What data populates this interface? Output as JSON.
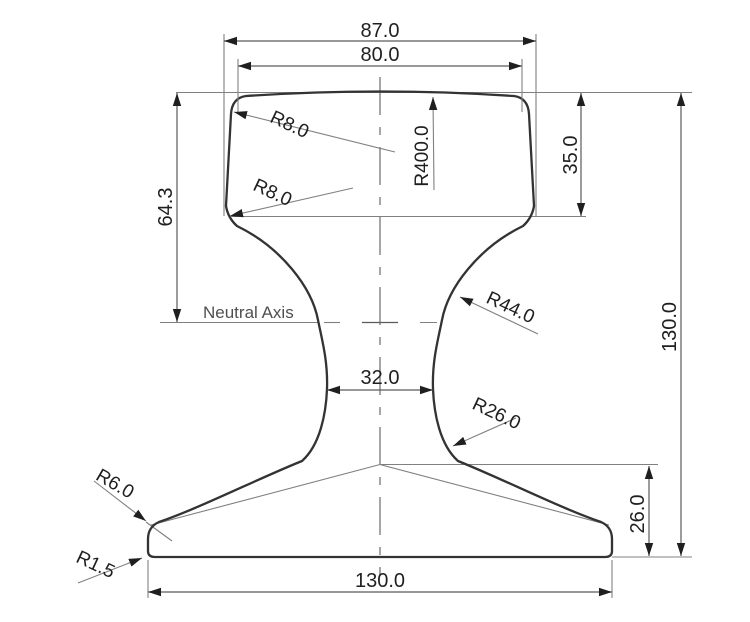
{
  "drawing": {
    "title": "Rail cross-section engineering drawing",
    "labels": {
      "neutral_axis": "Neutral Axis"
    },
    "dimensions": {
      "head_width_overall": "87.0",
      "head_top_width": "80.0",
      "top_to_neutral_axis": "64.3",
      "head_height": "35.0",
      "overall_height": "130.0",
      "web_thickness": "32.0",
      "foot_edge_height": "26.0",
      "foot_width": "130.0"
    },
    "radii": {
      "head_top_corner": "R8.0",
      "head_bottom_corner": "R8.0",
      "head_crown": "R400.0",
      "web_upper_fillet": "R44.0",
      "web_lower_fillet": "R26.0",
      "foot_top_corner": "R6.0",
      "foot_bottom_corner": "R1.5"
    },
    "colors": {
      "background": "#ffffff",
      "profile_stroke": "#333333",
      "dimension_stroke": "#808080",
      "text": "#1f1f1f"
    }
  }
}
